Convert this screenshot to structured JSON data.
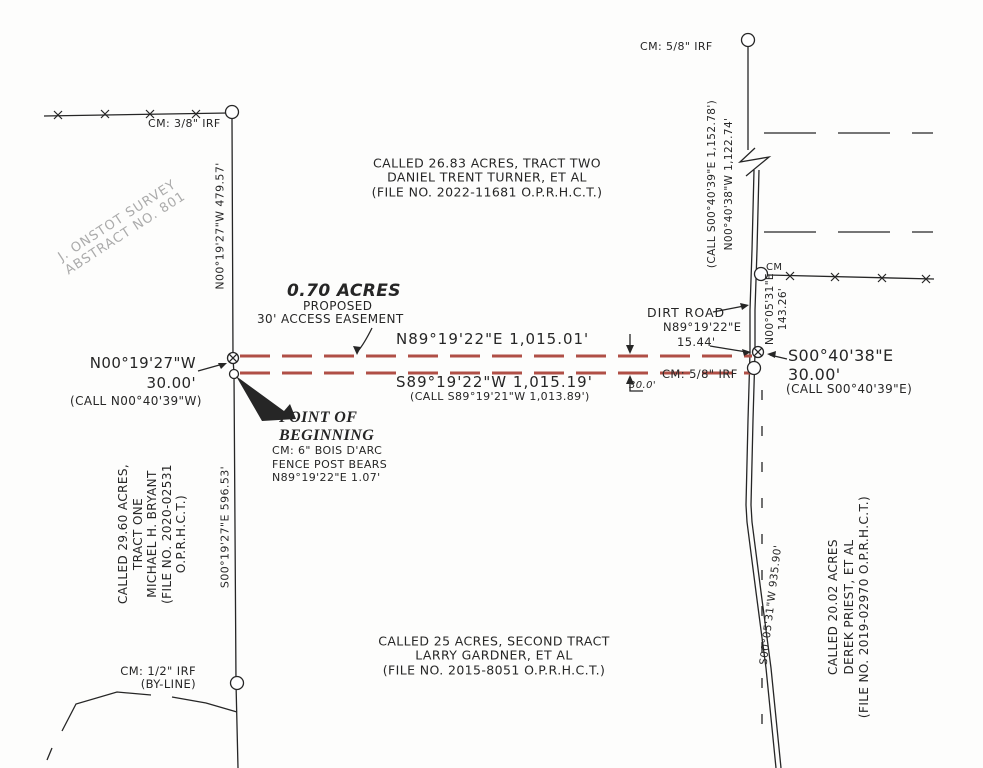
{
  "colors": {
    "ink": "#262626",
    "easement_red": "#b04f46",
    "survey_gray": "#ababab",
    "paper": "#fdfdfc"
  },
  "survey_block": {
    "line1": "J. ONSTOT SURVEY",
    "line2": "ABSTRACT NO. 801"
  },
  "parcels": {
    "turner": {
      "line1": "CALLED 26.83 ACRES, TRACT TWO",
      "line2": "DANIEL TRENT TURNER, ET AL",
      "line3": "(FILE NO. 2022-11681 O.P.R.H.C.T.)"
    },
    "bryant": {
      "line1": "CALLED 29.60 ACRES,",
      "line2": "TRACT ONE",
      "line3": "MICHAEL H. BRYANT",
      "line4": "(FILE NO. 2020-02531",
      "line5": "O.P.R.H.C.T.)"
    },
    "gardner": {
      "line1": "CALLED 25 ACRES, SECOND TRACT",
      "line2": "LARRY GARDNER, ET AL",
      "line3": "(FILE NO. 2015-8051 O.P.R.H.C.T.)"
    },
    "priest": {
      "line1": "CALLED 20.02 ACRES",
      "line2": "DEREK PRIEST, ET AL",
      "line3": "(FILE NO. 2019-02970 O.P.R.H.C.T.)"
    }
  },
  "easement": {
    "area": "0.70 ACRES",
    "proposed": "PROPOSED",
    "name": "30' ACCESS EASEMENT",
    "north_bearing": "N89°19'22\"E   1,015.01'",
    "south_bearing": "S89°19'22\"W   1,015.19'",
    "south_call": "(CALL S89°19'21\"W  1,013.89')",
    "width": "30.0'"
  },
  "west_tie": {
    "bearing": "N00°19'27\"W",
    "distance": "30.00'",
    "call": "(CALL N00°40'39\"W)"
  },
  "east_tie": {
    "bearing": "S00°40'38\"E",
    "distance": "30.00'",
    "call": "(CALL S00°40'39\"E)"
  },
  "pob": {
    "line1": "POINT OF",
    "line2": "BEGINNING",
    "note1": "CM:  6\" BOIS D'ARC",
    "note2": "FENCE POST BEARS",
    "note3": "N89°19'22\"E 1.07'"
  },
  "west_line": {
    "north": "N00°19'27\"W  479.57'",
    "south": "S00°19'27\"E  596.53'"
  },
  "east_line": {
    "call": "(CALL S00°40'39\"E  1,152.78')",
    "north": "N00°40'38\"W  1,122.74'",
    "mid_bearing": "N00°05'31\"E",
    "mid_distance": "143.26'",
    "south": "S00°05'31\"W  935.90'"
  },
  "dirt_road": {
    "label": "DIRT ROAD",
    "bearing": "N89°19'22\"E",
    "distance": "15.44'"
  },
  "monuments": {
    "nw": "CM:  3/8\" IRF",
    "ne": "CM:  5/8\" IRF",
    "east_mid": "CM",
    "east": "CM:  5/8\" IRF",
    "sw_line1": "CM:  1/2\" IRF",
    "sw_line2": "(BY-LINE)"
  }
}
